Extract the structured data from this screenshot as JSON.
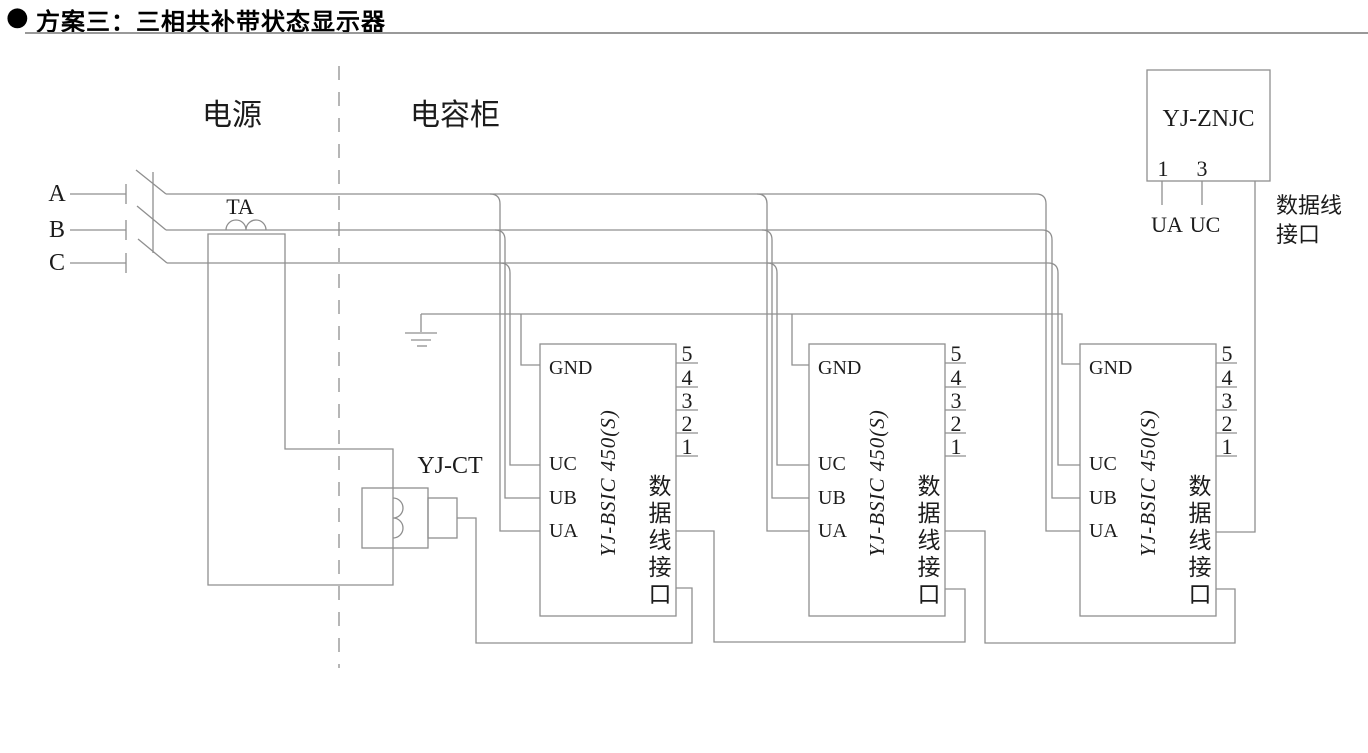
{
  "colors": {
    "line": "#8f8f8f",
    "text": "#1c1c1c",
    "title": "#000000",
    "rule": "#999999"
  },
  "title": {
    "bullet": "●",
    "text": "方案三：三相共补带状态显示器"
  },
  "sections": {
    "power": "电源",
    "capacitor": "电容柜"
  },
  "phases": [
    {
      "label": "A"
    },
    {
      "label": "B"
    },
    {
      "label": "C"
    }
  ],
  "ta": {
    "label": "TA"
  },
  "ct": {
    "label": "YJ-CT"
  },
  "znjc": {
    "name": "YJ-ZNJC",
    "pins": [
      "1",
      "3"
    ],
    "pin_labels": [
      "UA",
      "UC"
    ],
    "data_label_line1": "数据线",
    "data_label_line2": "接口"
  },
  "bsic_modules": [
    {
      "name": "YJ-BSIC 450(S)",
      "gnd_label": "GND",
      "inputs": [
        "UC",
        "UB",
        "UA"
      ],
      "pins": [
        "5",
        "4",
        "3",
        "2",
        "1"
      ],
      "data_port_label": "数据线接口"
    },
    {
      "name": "YJ-BSIC 450(S)",
      "gnd_label": "GND",
      "inputs": [
        "UC",
        "UB",
        "UA"
      ],
      "pins": [
        "5",
        "4",
        "3",
        "2",
        "1"
      ],
      "data_port_label": "数据线接口"
    },
    {
      "name": "YJ-BSIC 450(S)",
      "gnd_label": "GND",
      "inputs": [
        "UC",
        "UB",
        "UA"
      ],
      "pins": [
        "5",
        "4",
        "3",
        "2",
        "1"
      ],
      "data_port_label": "数据线接口"
    }
  ]
}
